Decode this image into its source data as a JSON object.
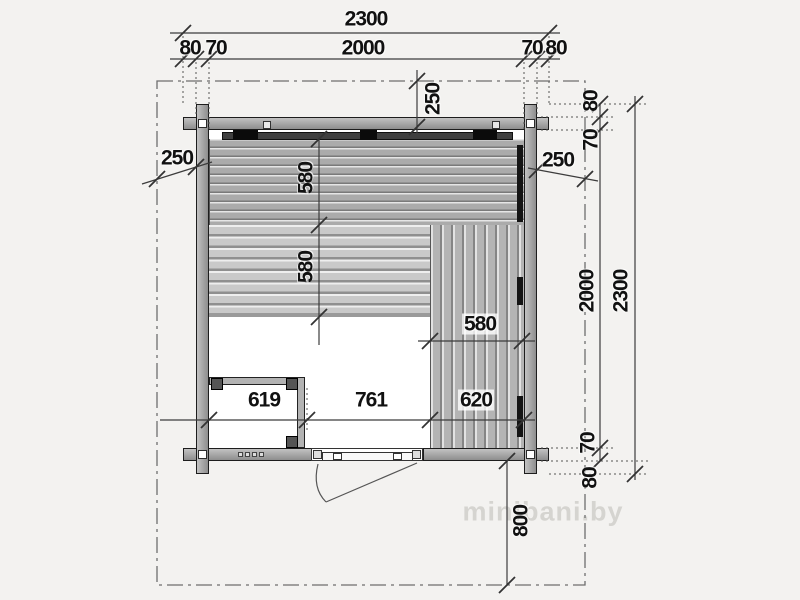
{
  "plan": {
    "watermark": "minibani.by",
    "dimensions": {
      "overall_width": "2300",
      "log_end_left": "80",
      "wall_left": "70",
      "interior_width": "2000",
      "wall_right": "70",
      "log_end_right": "80",
      "overhang_top": "250",
      "overhang_left": "250",
      "overhang_right": "250",
      "log_end_top": "80",
      "wall_top": "70",
      "interior_height": "2000",
      "overall_height": "2300",
      "wall_bottom": "70",
      "log_end_bottom": "80",
      "bench_top_depth": "580",
      "bench_mid_depth": "580",
      "bench_right_width": "580",
      "room_width": "619",
      "floor_opening_width": "761",
      "bench_bottom_width": "620",
      "porch_depth": "800"
    },
    "colors": {
      "background": "#f3f2f0",
      "wall": "#a8a8a8",
      "bench_upper": "#ababab",
      "bench_lower": "#c9c9c9",
      "bench_side": "#b4b4b4",
      "backrest": "#3f3f3f",
      "accent_black": "#111111",
      "dimension_line": "#3c3c3c"
    }
  }
}
